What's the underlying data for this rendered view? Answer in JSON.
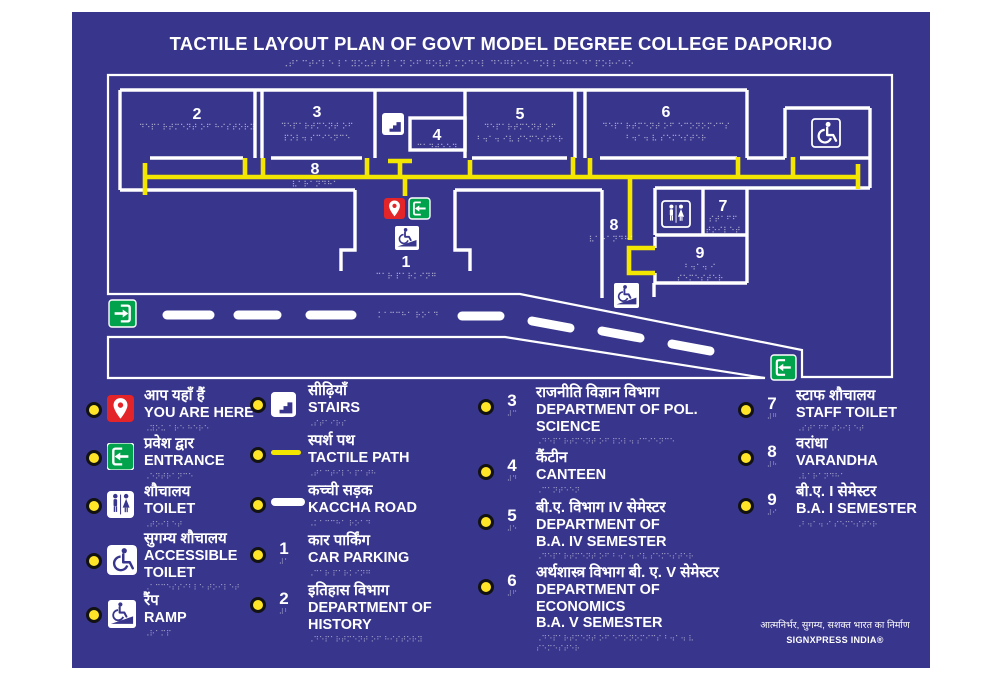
{
  "colors": {
    "panel": "#38358C",
    "tactile_yellow": "#F3E600",
    "marker_red": "#E32428",
    "entrance_green": "#00A24C",
    "legend_dot": "#FFE428",
    "line_white": "#FFFFFF"
  },
  "title": {
    "text": "TACTILE LAYOUT PLAN OF GOVT MODEL DEGREE COLLEGE DAPORIJO",
    "braille": "⠠⠞⠁⠉⠞⠊⠇⠑ ⠇⠁⠽⠕⠥⠞ ⠏⠇⠁⠝ ⠕⠋ ⠛⠕⠧⠞ ⠍⠕⠙⠑⠇ ⠙⠑⠛⠗⠑⠑ ⠉⠕⠇⠇⠑⠛⠑ ⠙⠁⠏⠕⠗⠊⠚⠕"
  },
  "icons": {
    "pin": "location-pin",
    "enter": "entrance-arrow-into-door",
    "wc": "wheelchair",
    "toilet": "man-woman-figures",
    "stairs": "step-flight",
    "wcramp": "wheelchair-on-ramp",
    "swatch-yellow": "tactile-path-line",
    "swatch-white": "kaccha-road-line",
    "dot": "yellow-legend-dot"
  },
  "map": {
    "labels": {
      "r2num": "2",
      "r2b1": "⠙⠑⠏⠁⠗⠞⠍⠑⠝⠞ ⠕⠋ ⠓⠊⠎⠞⠕⠗⠽",
      "r3num": "3",
      "r3b1": "⠙⠑⠏⠁⠗⠞⠍⠑⠝⠞ ⠕⠋",
      "r3b2": "⠏⠕⠇⠲ ⠎⠉⠊⠑⠝⠉⠑",
      "r4num": "4",
      "r4b1": "⠉⠁⠝⠞⠑⠑⠝",
      "r5num": "5",
      "r5b1": "⠙⠑⠏⠁⠗⠞⠍⠑⠝⠞ ⠕⠋",
      "r5b2": "⠃⠲⠁⠲ ⠊⠧ ⠎⠑⠍⠑⠎⠞⠑⠗",
      "r6num": "6",
      "r6b1": "⠙⠑⠏⠁⠗⠞⠍⠑⠝⠞ ⠕⠋ ⠑⠉⠕⠝⠕⠍⠊⠉⠎",
      "r6b2": "⠃⠲⠁⠲ ⠧ ⠎⠑⠍⠑⠎⠞⠑⠗",
      "c8num": "8",
      "c8b": "⠧⠁⠗⠁⠝⠙⠓⠁",
      "w8num": "8",
      "w8b": "⠧⠁⠗⠁⠝⠙⠓⠁",
      "r7num": "7",
      "r7b1": "⠎⠞⠁⠋⠋",
      "r7b2": "⠞⠕⠊⠇⠑⠞",
      "r9num": "9",
      "r9b1": "⠃⠲⠁⠲ ⠊",
      "r9b2": "⠎⠑⠍⠑⠎⠞⠑⠗",
      "p1num": "1",
      "p1b": "⠉⠁⠗ ⠏⠁⠗⠅⠊⠝⠛",
      "roadb": "⠅⠁⠉⠉⠓⠁ ⠗⠕⠁⠙"
    }
  },
  "legend": {
    "items": [
      {
        "icon": "pin",
        "hindi": "आप यहाँ हैं",
        "en": "YOU ARE HERE",
        "braille": "⠠⠽⠕⠥ ⠁⠗⠑ ⠓⠑⠗⠑"
      },
      {
        "icon": "enter",
        "hindi": "प्रवेश द्वार",
        "en": "ENTRANCE",
        "braille": "⠠⠑⠝⠞⠗⠁⠝⠉⠑"
      },
      {
        "icon": "toilet",
        "hindi": "शौचालय",
        "en": "TOILET",
        "braille": "⠠⠞⠕⠊⠇⠑⠞"
      },
      {
        "icon": "wc",
        "hindi": "सुगम्य शौचालय",
        "en": "ACCESSIBLE",
        "en2": "TOILET",
        "braille": "⠠⠁⠉⠉⠑⠎⠎⠊⠃⠇⠑ ⠞⠕⠊⠇⠑⠞"
      },
      {
        "icon": "wcramp",
        "hindi": "रैंप",
        "en": "RAMP",
        "braille": "⠠⠗⠁⠍⠏"
      },
      {
        "icon": "stairs",
        "hindi": "सीढ़ियाँ",
        "en": "STAIRS",
        "braille": "⠠⠎⠞⠁⠊⠗⠎"
      },
      {
        "icon": "swatch-yellow",
        "hindi": "स्पर्श पथ",
        "en": "TACTILE PATH",
        "braille": "⠠⠞⠁⠉⠞⠊⠇⠑ ⠏⠁⠞⠓"
      },
      {
        "icon": "swatch-white",
        "hindi": "कच्ची सड़क",
        "en": "KACCHA ROAD",
        "braille": "⠠⠅⠁⠉⠉⠓⠁ ⠗⠕⠁⠙"
      },
      {
        "num": "1",
        "numBraille": "⠼⠁",
        "hindi": "कार पार्किंग",
        "en": "CAR PARKING",
        "braille": "⠠⠉⠁⠗ ⠏⠁⠗⠅⠊⠝⠛"
      },
      {
        "num": "2",
        "numBraille": "⠼⠃",
        "hindi": "इतिहास विभाग",
        "en": "DEPARTMENT OF HISTORY",
        "braille": "⠠⠙⠑⠏⠁⠗⠞⠍⠑⠝⠞ ⠕⠋ ⠓⠊⠎⠞⠕⠗⠽"
      },
      {
        "num": "3",
        "numBraille": "⠼⠉",
        "hindi": "राजनीति विज्ञान विभाग",
        "en": "DEPARTMENT OF POL.",
        "en2": "SCIENCE",
        "braille": "⠠⠙⠑⠏⠁⠗⠞⠍⠑⠝⠞ ⠕⠋ ⠏⠕⠇⠲ ⠎⠉⠊⠑⠝⠉⠑"
      },
      {
        "num": "4",
        "numBraille": "⠼⠙",
        "hindi": "कैंटीन",
        "en": "CANTEEN",
        "braille": "⠠⠉⠁⠝⠞⠑⠑⠝"
      },
      {
        "num": "5",
        "numBraille": "⠼⠑",
        "hindi": "बी.ए. विभाग IV सेमेस्टर",
        "en": "DEPARTMENT OF",
        "en2": "B.A. IV SEMESTER",
        "braille": "⠠⠙⠑⠏⠁⠗⠞⠍⠑⠝⠞ ⠕⠋ ⠃⠲⠁⠲ ⠊⠧ ⠎⠑⠍⠑⠎⠞⠑⠗"
      },
      {
        "num": "6",
        "numBraille": "⠼⠋",
        "hindi": "अर्थशास्त्र विभाग बी. ए. V सेमेस्टर",
        "en": "DEPARTMENT OF ECONOMICS",
        "en2": "B.A. V SEMESTER",
        "braille": "⠠⠙⠑⠏⠁⠗⠞⠍⠑⠝⠞ ⠕⠋ ⠑⠉⠕⠝⠕⠍⠊⠉⠎ ⠃⠲⠁⠲ ⠧ ⠎⠑⠍⠑⠎⠞⠑⠗"
      },
      {
        "num": "7",
        "numBraille": "⠼⠛",
        "hindi": "स्टाफ शौचालय",
        "en": "STAFF TOILET",
        "braille": "⠠⠎⠞⠁⠋⠋ ⠞⠕⠊⠇⠑⠞"
      },
      {
        "num": "8",
        "numBraille": "⠼⠓",
        "hindi": "वरांधा",
        "en": "VARANDHA",
        "braille": "⠠⠧⠁⠗⠁⠝⠙⠓⠁"
      },
      {
        "num": "9",
        "numBraille": "⠼⠊",
        "hindi": "बी.ए. I सेमेस्टर",
        "en": "B.A. I SEMESTER",
        "braille": "⠠⠃⠲⠁⠲ ⠊ ⠎⠑⠍⠑⠎⠞⠑⠗"
      }
    ]
  },
  "footer": {
    "tagline": "आत्मनिर्भर, सुगम्य, सशक्त भारत का निर्माण",
    "brand": "SIGNXPRESS INDIA®"
  }
}
